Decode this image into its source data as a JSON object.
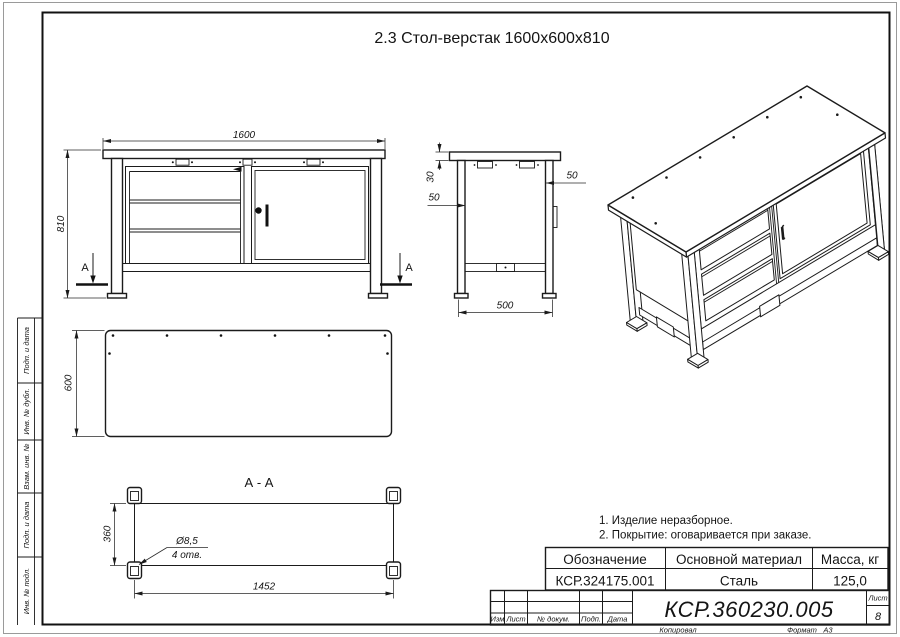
{
  "title": "2.3 Стол-верстак 1600х600х810",
  "views": {
    "front": {
      "dim_width": "1600",
      "dim_height": "810",
      "section_mark": "А"
    },
    "side": {
      "dim_top": "30",
      "dim_inset_left": "50",
      "dim_inset_right": "50",
      "dim_base": "500"
    },
    "top": {
      "dim_depth": "600"
    },
    "section": {
      "title": "А - А",
      "dim_feet_depth": "360",
      "dim_feet_width": "1452",
      "hole_dia": "Ø8,5",
      "hole_qty": "4 отв."
    }
  },
  "notes": [
    "1. Изделие неразборное.",
    "2. Покрытие: оговаривается при заказе."
  ],
  "spec_table": {
    "headers": [
      "Обозначение",
      "Основной материал",
      "Масса, кг"
    ],
    "row": [
      "КСР.324175.001",
      "Сталь",
      "125,0"
    ]
  },
  "title_block": {
    "doc_number": "КСР.360230.005",
    "sheet_label": "Лист",
    "sheet_value": "8",
    "columns": [
      "Изм",
      "Лист",
      "№ докум.",
      "Подп.",
      "Дата"
    ],
    "copied_label": "Копировал",
    "format_label": "Формат",
    "format_value": "А3"
  },
  "margin_labels": [
    "Подп. и дата",
    "Инв. № дубл.",
    "Взам. инв. №",
    "Подп. и дата",
    "Инв. № подл."
  ]
}
